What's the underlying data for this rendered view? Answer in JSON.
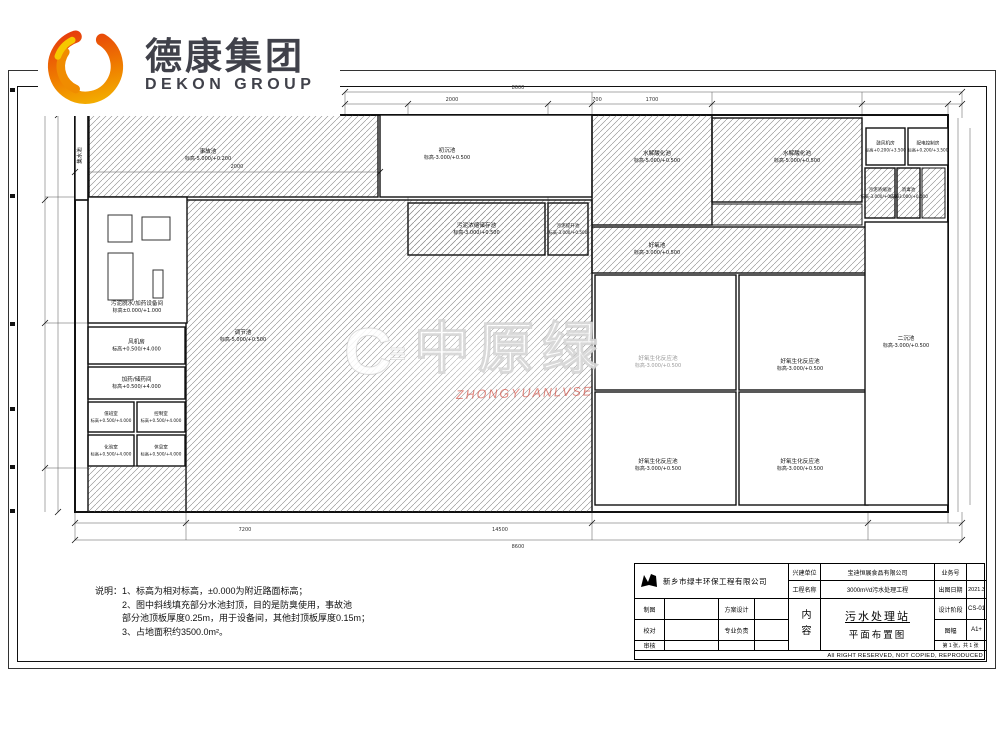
{
  "brand": {
    "cn": "德康集团",
    "en": "DEKON GROUP"
  },
  "watermark": {
    "mark": "C",
    "bars": "≡",
    "text": "中原绿",
    "subtext": "ZHONGYUANLVSE"
  },
  "notes": {
    "l1": "说明：1、标高为相对标高，±0.000为附近路面标高；",
    "l2": "2、图中斜线填充部分水池封顶，目的是防臭使用，事故池",
    "l3": "部分池顶板厚度0.25m，用于设备间，其他封顶板厚度0.15m；",
    "l4": "3、占地面积约3500.0m²。"
  },
  "title_block": {
    "company": "新乡市绿丰环保工程有限公司",
    "fields": {
      "owner_label": "兴建单位",
      "owner": "宝迪恒展食品有限公司",
      "project_label": "工程名称",
      "project": "3000m³/d污水处理工程",
      "job_no_label": "业务号",
      "job_no": "",
      "date_label": "出图日期",
      "date": "2021.3",
      "draw_label": "制图",
      "scheme_label": "方案设计",
      "check_label": "校对",
      "lead_label": "专业负责",
      "review_label": "审核",
      "content_label": "内容",
      "content_line1": "污水处理站",
      "content_line2": "平面布置图",
      "stage_label": "设计阶段",
      "stage": "CS-01",
      "size_label": "图幅",
      "size": "A1+",
      "sheet": "第 1 张，共 1 张",
      "rights": "All RIGHT RESERVED, NOT COPIED, REPRODUCED"
    }
  },
  "plan": {
    "tanks": [
      {
        "name": "调节池",
        "elev": "标高-5.000/+0.500",
        "x": 186,
        "y": 200,
        "w": 406,
        "h": 312,
        "hatch": true,
        "lx": 243,
        "ly": 334
      },
      {
        "name": "事故池",
        "elev": "标高-5.000/+0.200",
        "x": 89,
        "y": 115,
        "w": 289,
        "h": 82,
        "hatch": true,
        "lx": 208,
        "ly": 153
      },
      {
        "name": "初沉池",
        "elev": "标高-3.000/+0.500",
        "x": 380,
        "y": 115,
        "w": 212,
        "h": 82,
        "hatch": false,
        "lx": 447,
        "ly": 152
      },
      {
        "name": "水解酸化池",
        "elev": "标高-5.000/+0.500",
        "x": 592,
        "y": 115,
        "w": 120,
        "h": 110,
        "hatch": true,
        "lx": 657,
        "ly": 155
      },
      {
        "name": "水解酸化池",
        "elev": "标高-5.000/+0.500",
        "x": 712,
        "y": 118,
        "w": 150,
        "h": 84,
        "hatch": true,
        "lx": 797,
        "ly": 155
      },
      {
        "name": "好氧池",
        "elev": "标高-3.000/+0.500",
        "x": 592,
        "y": 227,
        "w": 276,
        "h": 46,
        "hatch": true,
        "lx": 657,
        "ly": 247
      },
      {
        "name": "好氧生化反应池",
        "elev": "标高-3.000/+0.500",
        "x": 595,
        "y": 275,
        "w": 141,
        "h": 115,
        "hatch": false,
        "lx": 658,
        "ly": 360,
        "faint": true
      },
      {
        "name": "好氧生化反应池",
        "elev": "标高-3.000/+0.500",
        "x": 739,
        "y": 275,
        "w": 129,
        "h": 115,
        "hatch": false,
        "lx": 800,
        "ly": 363
      },
      {
        "name": "好氧生化反应池",
        "elev": "标高-3.000/+0.500",
        "x": 595,
        "y": 392,
        "w": 141,
        "h": 113,
        "hatch": false,
        "lx": 658,
        "ly": 463
      },
      {
        "name": "好氧生化反应池",
        "elev": "标高-3.000/+0.500",
        "x": 739,
        "y": 392,
        "w": 129,
        "h": 113,
        "hatch": false,
        "lx": 800,
        "ly": 463
      },
      {
        "name": "鼓风机房",
        "elev": "标高+0.200/+3.500",
        "x": 866,
        "y": 128,
        "w": 39,
        "h": 37,
        "hatch": false
      },
      {
        "name": "配电控制房",
        "elev": "标高+0.200/+3.500",
        "x": 908,
        "y": 128,
        "w": 40,
        "h": 37,
        "hatch": false
      },
      {
        "name": "污泥浓缩池",
        "elev": "标高-3.000/+0.500",
        "x": 865,
        "y": 168,
        "w": 30,
        "h": 50,
        "hatch": true
      },
      {
        "name": "消毒池",
        "elev": "标高-3.000/+0.500",
        "x": 897,
        "y": 168,
        "w": 23,
        "h": 50,
        "hatch": true
      },
      {
        "name": "二沉池",
        "elev": "标高-3.000/+0.500",
        "x": 865,
        "y": 222,
        "w": 83,
        "h": 283,
        "hatch": false,
        "lx": 906,
        "ly": 340
      },
      {
        "name": "污泥浓缩储存池",
        "elev": "标高-3.000/+0.500",
        "x": 408,
        "y": 203,
        "w": 137,
        "h": 52,
        "hatch": true
      },
      {
        "name": "污泥提升池",
        "elev": "标高-3.000/+0.500",
        "x": 548,
        "y": 203,
        "w": 40,
        "h": 52,
        "hatch": true
      },
      {
        "name": "污泥脱水/加药设备间",
        "elev": "标高±0.000/+1.000",
        "x": 88,
        "y": 197,
        "w": 99,
        "h": 126,
        "hatch": false,
        "lx": 137,
        "ly": 305
      },
      {
        "name": "风机房",
        "elev": "标高+0.500/+4.000",
        "x": 88,
        "y": 327,
        "w": 97,
        "h": 37,
        "hatch": false
      },
      {
        "name": "加药/储药间",
        "elev": "标高+0.500/+4.000",
        "x": 88,
        "y": 367,
        "w": 97,
        "h": 32,
        "hatch": false
      },
      {
        "name": "值班室",
        "elev": "标高+0.500/+4.000",
        "x": 88,
        "y": 402,
        "w": 46,
        "h": 30,
        "hatch": false
      },
      {
        "name": "控制室",
        "elev": "标高+0.500/+4.000",
        "x": 137,
        "y": 402,
        "w": 48,
        "h": 30,
        "hatch": false
      },
      {
        "name": "化验室",
        "elev": "标高+0.500/+4.000",
        "x": 88,
        "y": 435,
        "w": 46,
        "h": 31,
        "hatch": false
      },
      {
        "name": "休息室",
        "elev": "标高+0.500/+4.000",
        "x": 137,
        "y": 435,
        "w": 48,
        "h": 31,
        "hatch": false
      },
      {
        "name": "集水池",
        "elev": "",
        "x": 75,
        "y": 115,
        "w": 13,
        "h": 85,
        "hatch": false,
        "rot": true
      }
    ],
    "extras": [
      [
        712,
        204,
        150,
        21
      ],
      [
        922,
        168,
        23,
        50
      ],
      [
        88,
        466,
        98,
        46
      ]
    ],
    "equipment": [
      [
        108,
        215,
        24,
        27
      ],
      [
        142,
        217,
        28,
        23
      ],
      [
        108,
        253,
        25,
        47
      ],
      [
        153,
        270,
        10,
        28
      ]
    ],
    "walls": [
      [
        88,
        115,
        88,
        512
      ],
      [
        75,
        200,
        88,
        200
      ]
    ],
    "dims": [
      {
        "t": "8600",
        "x": 518,
        "y": 89
      },
      {
        "t": "2000",
        "x": 452,
        "y": 101
      },
      {
        "t": "700",
        "x": 597,
        "y": 101
      },
      {
        "t": "1700",
        "x": 652,
        "y": 101
      },
      {
        "t": "2000",
        "x": 237,
        "y": 168
      },
      {
        "t": "7200",
        "x": 245,
        "y": 531
      },
      {
        "t": "14500",
        "x": 500,
        "y": 531
      },
      {
        "t": "8600",
        "x": 518,
        "y": 548
      }
    ],
    "lines": [
      [
        345,
        92,
        962,
        92
      ],
      [
        345,
        104,
        962,
        104
      ],
      [
        45,
        115,
        45,
        512
      ],
      [
        58,
        115,
        58,
        512
      ],
      [
        958,
        118,
        958,
        512
      ],
      [
        970,
        128,
        970,
        505
      ],
      [
        75,
        523,
        962,
        523
      ],
      [
        75,
        540,
        962,
        540
      ],
      [
        75,
        172,
        380,
        172
      ],
      [
        408,
        104,
        408,
        203
      ],
      [
        548,
        104,
        548,
        203
      ],
      [
        592,
        92,
        592,
        115
      ],
      [
        712,
        92,
        712,
        118
      ],
      [
        862,
        92,
        862,
        128
      ],
      [
        948,
        104,
        948,
        128
      ],
      [
        186,
        512,
        186,
        540
      ],
      [
        592,
        512,
        592,
        540
      ],
      [
        868,
        512,
        868,
        540
      ],
      [
        948,
        512,
        948,
        523
      ],
      [
        345,
        92,
        345,
        115
      ],
      [
        962,
        92,
        962,
        118
      ],
      [
        75,
        512,
        75,
        540
      ],
      [
        962,
        512,
        962,
        540
      ],
      [
        45,
        197,
        88,
        197
      ],
      [
        45,
        323,
        88,
        323
      ],
      [
        45,
        468,
        88,
        468
      ]
    ],
    "ticks": [
      [
        345,
        92
      ],
      [
        962,
        92
      ],
      [
        345,
        104
      ],
      [
        408,
        104
      ],
      [
        548,
        104
      ],
      [
        592,
        104
      ],
      [
        712,
        104
      ],
      [
        862,
        104
      ],
      [
        948,
        104
      ],
      [
        962,
        104
      ],
      [
        75,
        172
      ],
      [
        380,
        172
      ],
      [
        75,
        523
      ],
      [
        186,
        523
      ],
      [
        592,
        523
      ],
      [
        868,
        523
      ],
      [
        962,
        523
      ],
      [
        75,
        540
      ],
      [
        962,
        540
      ],
      [
        45,
        200
      ],
      [
        45,
        323
      ],
      [
        45,
        468
      ],
      [
        58,
        115
      ],
      [
        58,
        512
      ]
    ],
    "markers": [
      [
        10,
        88
      ],
      [
        10,
        194
      ],
      [
        10,
        322
      ],
      [
        10,
        407
      ],
      [
        10,
        465
      ],
      [
        10,
        509
      ]
    ]
  }
}
